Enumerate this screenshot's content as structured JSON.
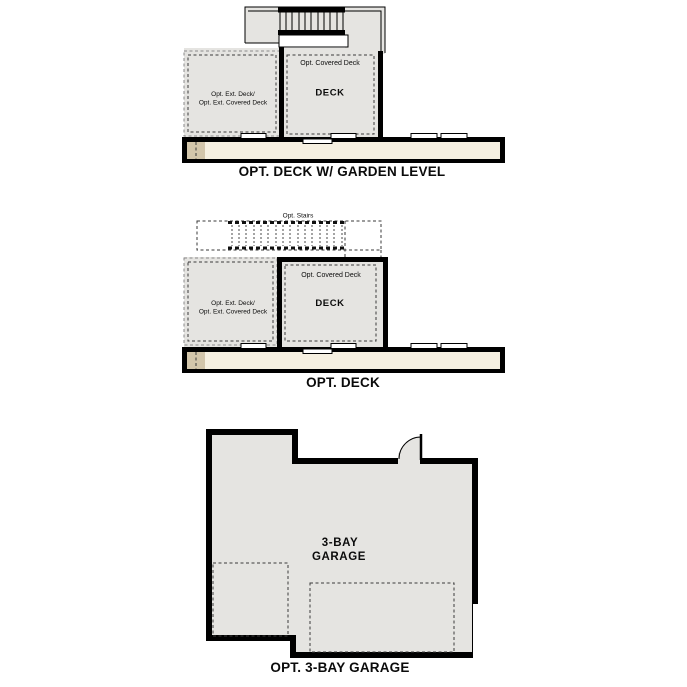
{
  "colors": {
    "wall": "#000000",
    "area_fill": "#e5e4e1",
    "band_fill": "#f6f0e1",
    "garden_strip_fill": "#d3c6ab",
    "window_fill": "#ffffff"
  },
  "plans": {
    "deck_garden_level": {
      "caption": "OPT. DECK W/ GARDEN LEVEL",
      "labels": {
        "covered_deck": "Opt. Covered Deck",
        "deck": "DECK",
        "ext_deck_line1": "Opt. Ext. Deck/",
        "ext_deck_line2": "Opt. Ext. Covered Deck"
      }
    },
    "deck": {
      "caption": "OPT. DECK",
      "labels": {
        "opt_stairs": "Opt. Stairs",
        "covered_deck": "Opt. Covered Deck",
        "deck": "DECK",
        "ext_deck_line1": "Opt. Ext. Deck/",
        "ext_deck_line2": "Opt. Ext. Covered Deck"
      }
    },
    "garage": {
      "caption": "OPT. 3-BAY GARAGE",
      "labels": {
        "garage_line1": "3-BAY",
        "garage_line2": "GARAGE"
      }
    }
  }
}
